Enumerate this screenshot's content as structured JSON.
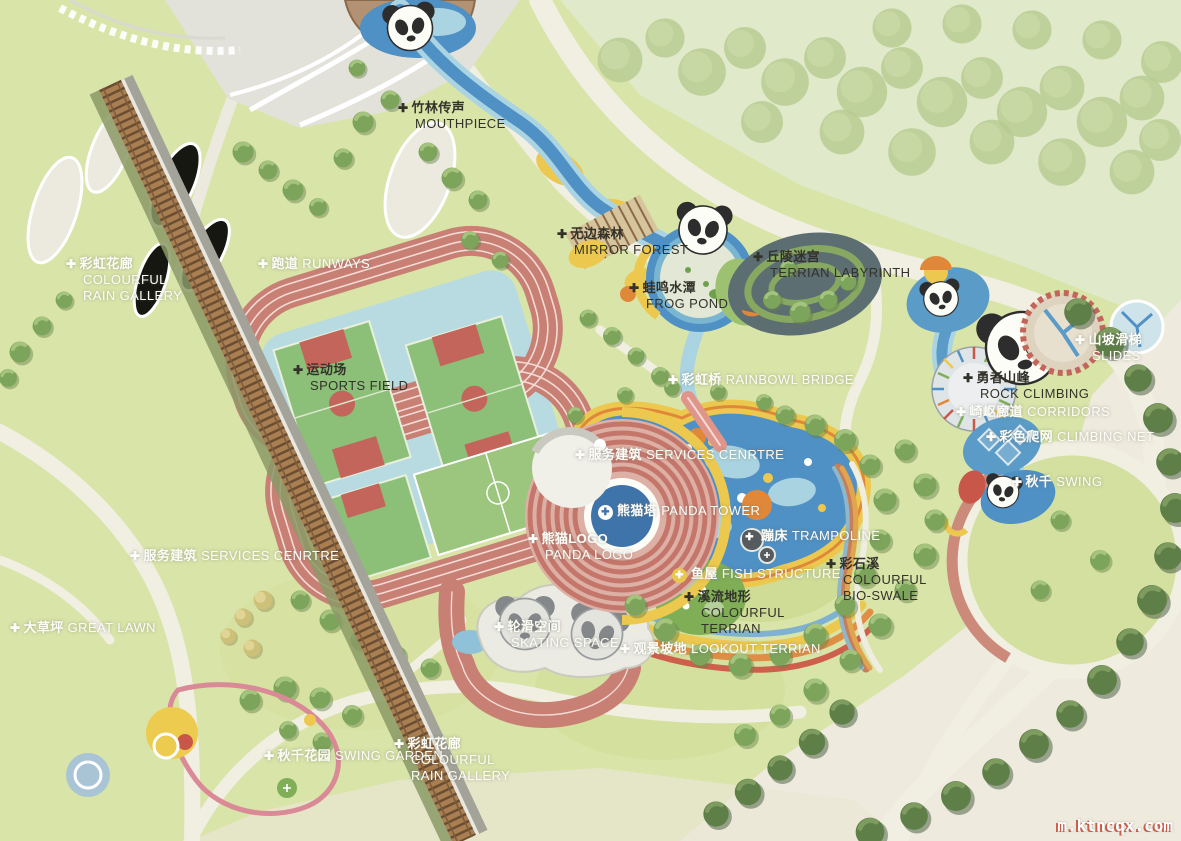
{
  "title": "Panda theme park masterplan",
  "watermark": "m.ktncqx.com",
  "icons": {
    "plus_marker": "✚"
  },
  "palette": {
    "lawn": "#d9e4a9",
    "pale_wood_green": "#e3ebcd",
    "cream_road": "#f1eee2",
    "water": "#4f90c5",
    "light_water": "#aad4e2",
    "track": "#c87f74",
    "court_green": "#8cbf78",
    "court_red": "#c4655c",
    "band_yellow": "#ecc84e",
    "band_orange": "#e0883a",
    "band_red": "#cf5f4d",
    "tree_light": "#7ca45b",
    "tree_dark": "#5f7f49",
    "pergola_wood": "#a97f52",
    "pool_deck": "#b7dbe1"
  },
  "labels": {
    "mouthpiece": {
      "zh": "竹林传声",
      "en": "MOUTHPIECE"
    },
    "mirror_forest": {
      "zh": "无边森林",
      "en": "MIRROR FOREST"
    },
    "frog_pond": {
      "zh": "蛙鸣水潭",
      "en": "FROG POND"
    },
    "terrian_labyrinth": {
      "zh": "丘陵迷宫",
      "en": "TERRIAN LABYRINTH"
    },
    "runways": {
      "zh": "跑道",
      "en": "RUNWAYS"
    },
    "sports_field": {
      "zh": "运动场",
      "en": "SPORTS FIELD"
    },
    "rainbowl_bridge": {
      "zh": "彩虹桥",
      "en": "RAINBOWL BRIDGE"
    },
    "services_centre": {
      "zh": "服务建筑",
      "en": "SERVICES CENRTRE"
    },
    "panda_tower": {
      "zh": "熊猫塔",
      "en": "PANDA TOWER"
    },
    "panda_logo": {
      "zh": "熊猫LOGO",
      "en": "PANDA LOGO"
    },
    "trampoline": {
      "zh": "蹦床",
      "en": "TRAMPOLINE"
    },
    "fish_structure": {
      "zh": "鱼屋",
      "en": "FISH STRUCTURE"
    },
    "colourful_terrian": {
      "zh": "溪流地形",
      "en_1": "COLOURFUL",
      "en_2": "TERRIAN"
    },
    "bio_swale": {
      "zh": "彩石溪",
      "en_1": "COLOURFUL",
      "en_2": "BIO-SWALE"
    },
    "rock_climbing": {
      "zh": "勇者山峰",
      "en": "ROCK CLIMBING"
    },
    "slides": {
      "zh": "山坡滑梯",
      "en": "SLIDES"
    },
    "corridors": {
      "zh": "崎岖廊道",
      "en": "CORRIDORS"
    },
    "climbing_net": {
      "zh": "彩色爬网",
      "en": "CLIMBING NET"
    },
    "swing": {
      "zh": "秋千",
      "en": "SWING"
    },
    "skating": {
      "zh": "轮滑空间",
      "en": "SKATING SPACE"
    },
    "lookout_terrian": {
      "zh": "观景坡地",
      "en": "LOOKOUT TERRIAN"
    },
    "rain_gallery_top": {
      "zh": "彩虹花廊",
      "en_1": "COLOURFUL",
      "en_2": "RAIN GALLERY"
    },
    "services_centre_left": {
      "zh": "服务建筑",
      "en": "SERVICES CENRTRE"
    },
    "great_lawn": {
      "zh": "大草坪",
      "en": "GREAT LAWN"
    },
    "swing_garden": {
      "zh": "秋千花园",
      "en": "SWING GARDEN"
    },
    "rain_gallery_bottom": {
      "zh": "彩虹花廊",
      "en_1": "COLOURFUL",
      "en_2": "RAIN GALLERY"
    }
  }
}
